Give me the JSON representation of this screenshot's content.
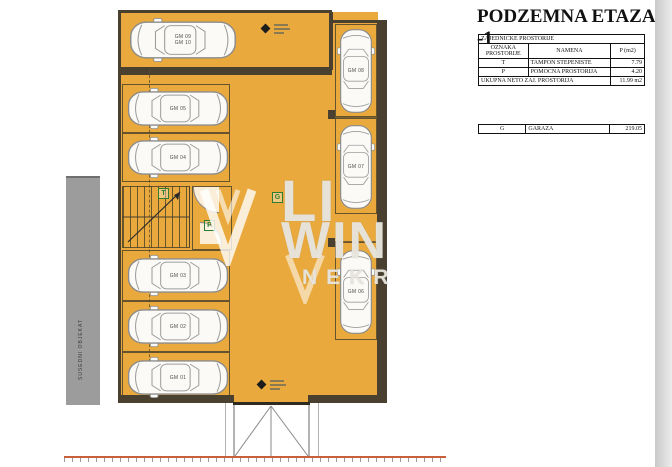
{
  "header": {
    "title": "PODZEMNA ETAZA -1"
  },
  "shared_table": {
    "caption": "ZAJEDNICKE PROSTORIJE",
    "columns": {
      "oznaka": "OZNAKA PROSTORIJE",
      "namena": "NAMENA",
      "p": "P (m2)"
    },
    "rows": [
      {
        "oznaka": "T",
        "namena": "TAMPON STEPENISTE",
        "p": "7.79"
      },
      {
        "oznaka": "P",
        "namena": "POMOCNA PROSTORIJA",
        "p": "4.20"
      }
    ],
    "total_label": "UKUPNA NETO ZAJ. PROSTORIJA",
    "total_value": "11.99 m2"
  },
  "garage_table": {
    "oznaka": "G",
    "namena": "GARAZA",
    "p": "219.05"
  },
  "plan": {
    "tandem_spot": {
      "line1": "GM 09",
      "line2": "GM 10"
    },
    "spots": [
      {
        "label": "GM 05"
      },
      {
        "label": "GM 04"
      },
      {
        "label": "GM 03"
      },
      {
        "label": "GM 02"
      },
      {
        "label": "GM 01"
      },
      {
        "label": "GM 08"
      },
      {
        "label": "GM 07"
      },
      {
        "label": "GM 06"
      }
    ],
    "room_labels": {
      "garage": "G",
      "stairs": "T",
      "aux": "P"
    },
    "neighbor_label": "SUSEDNI OBJEKAT",
    "watermark": {
      "line1": "LI",
      "line2": "WIN",
      "line3": "NEKR"
    }
  },
  "colors": {
    "floor": "#e9a93c",
    "wall": "#4a4030",
    "ground_line": "#c7603a",
    "label_green": "#2f7d33",
    "neighbor_gray": "#9c9c9c"
  }
}
